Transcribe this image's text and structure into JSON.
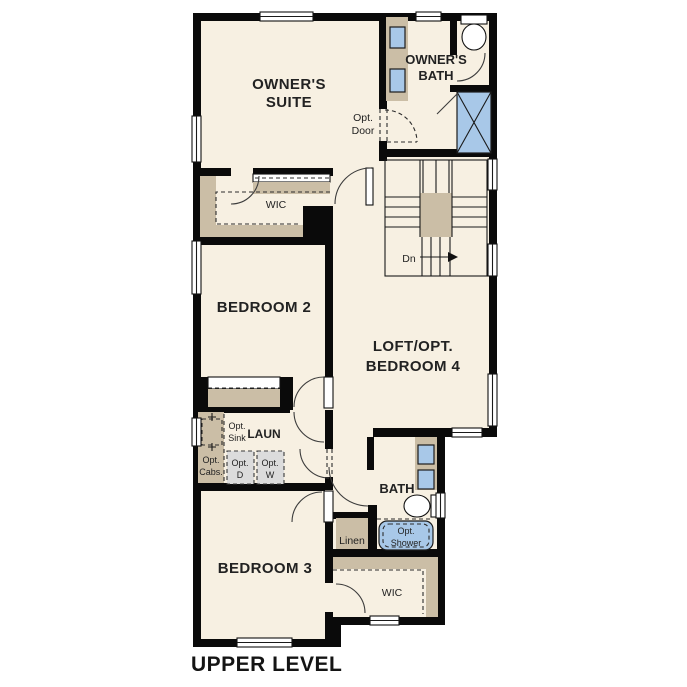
{
  "title": "UPPER LEVEL",
  "colors": {
    "background": "#ffffff",
    "floor": "#f7f0e2",
    "wall": "#0a0a0a",
    "cabinet_tan": "#cbbea6",
    "fixture_blue": "#a8c8e8",
    "appliance_gray": "#dcdcdc",
    "text": "#222222"
  },
  "labels": {
    "owners_suite": [
      "OWNER'S",
      "SUITE"
    ],
    "owners_bath": [
      "OWNER'S",
      "BATH"
    ],
    "opt_door": [
      "Opt.",
      "Door"
    ],
    "wic_upper": "WIC",
    "stairs_down": "Dn",
    "bedroom2": "BEDROOM 2",
    "loft": [
      "LOFT/OPT.",
      "BEDROOM 4"
    ],
    "opt_sink": [
      "Opt.",
      "Sink"
    ],
    "laundry": "LAUN",
    "opt_cabs": [
      "Opt.",
      "Cabs."
    ],
    "opt_dryer": [
      "Opt.",
      "D"
    ],
    "opt_washer": [
      "Opt.",
      "W"
    ],
    "bath": "BATH",
    "linen": "Linen",
    "opt_shower": [
      "Opt.",
      "Shower"
    ],
    "wic_lower": "WIC",
    "bedroom3": "BEDROOM 3"
  }
}
